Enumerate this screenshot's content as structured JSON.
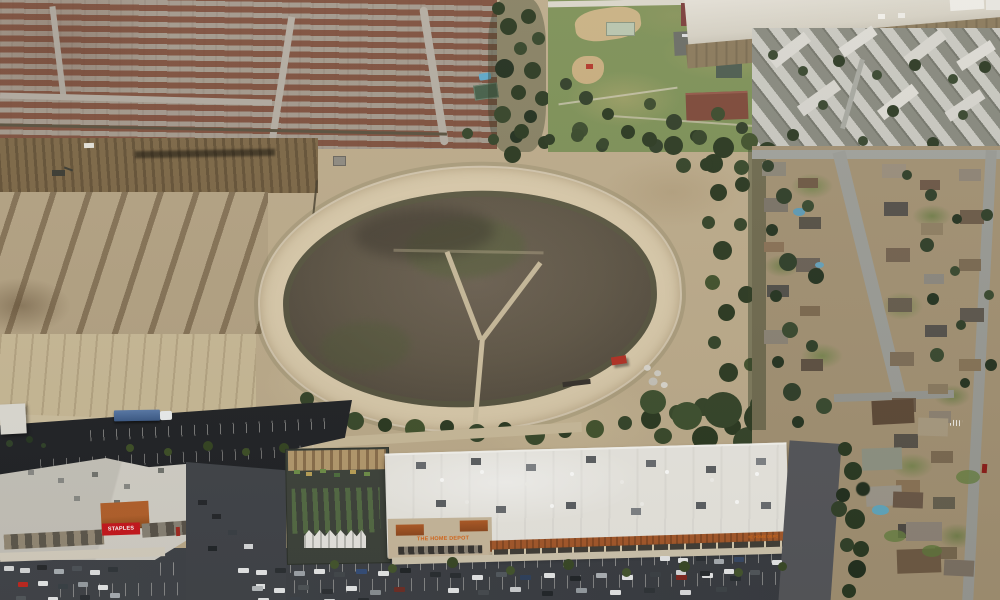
{
  "meta": {
    "type": "aerial-photograph",
    "description": "Oblique aerial photo of a suburban redevelopment site: a vacant oval dirt racetrack with a dark weedy infield and Y-shaped paths sits between new red-roofed tract housing and graded dirt lots (upper/left), a community park, flood-channel levee and apartment complex (upper right), an established tree-lined neighborhood with backyard pools (right), and a shopping center anchored by The Home Depot with a garden center, a Staples store, parking lots and a semi truck (bottom)."
  },
  "signs": {
    "home_depot_main": "THE HOME DEPOT",
    "home_depot_right": "THE HOME DEPOT",
    "staples": "STAPLES"
  },
  "palette": {
    "dirt_light": "#c8b996",
    "dirt_apron": "#bcab8b",
    "track_ring": "#d8c9aa",
    "infield_dark": "#5a5244",
    "tract_roof": "#7d4d3a",
    "tree_green": "#36452a",
    "park_green": "#7e9158",
    "asphalt_new": "#222427",
    "asphalt_lot": "#3d4045",
    "hd_roof_white": "#e9e7e0",
    "terracotta": "#a55a2c",
    "hd_sign_orange": "#d96a1d",
    "staples_red": "#c8191f",
    "levee_concrete": "#dcd8cd",
    "apartment_roof": "#d8d6cf"
  },
  "regions": [
    {
      "name": "tract-housing-northwest",
      "description": "Dense new tract homes with red-brown tile roofs"
    },
    {
      "name": "tree-row",
      "description": "Tall dark tree row between housing and park"
    },
    {
      "name": "community-park",
      "description": "Park with ball field, tennis courts, playground, picnic building and parking"
    },
    {
      "name": "flood-channel-levee",
      "description": "Pale concrete flood-control embankment"
    },
    {
      "name": "apartment-complex-northeast",
      "description": "Light gray angled apartment rooftops"
    },
    {
      "name": "graded-dirt-lots",
      "description": "Cleared construction dirt with windrows of rubble and an excavator"
    },
    {
      "name": "oval-dirt-track",
      "description": "Abandoned oval dirt track, dark infield, Y-shaped paths, red tractor at east side"
    },
    {
      "name": "older-neighborhood-east",
      "description": "Established single-family homes, mature trees, backyard pools"
    },
    {
      "name": "shopping-center-south",
      "description": "The Home Depot with garden center, Staples, parking lots, semi truck"
    }
  ]
}
